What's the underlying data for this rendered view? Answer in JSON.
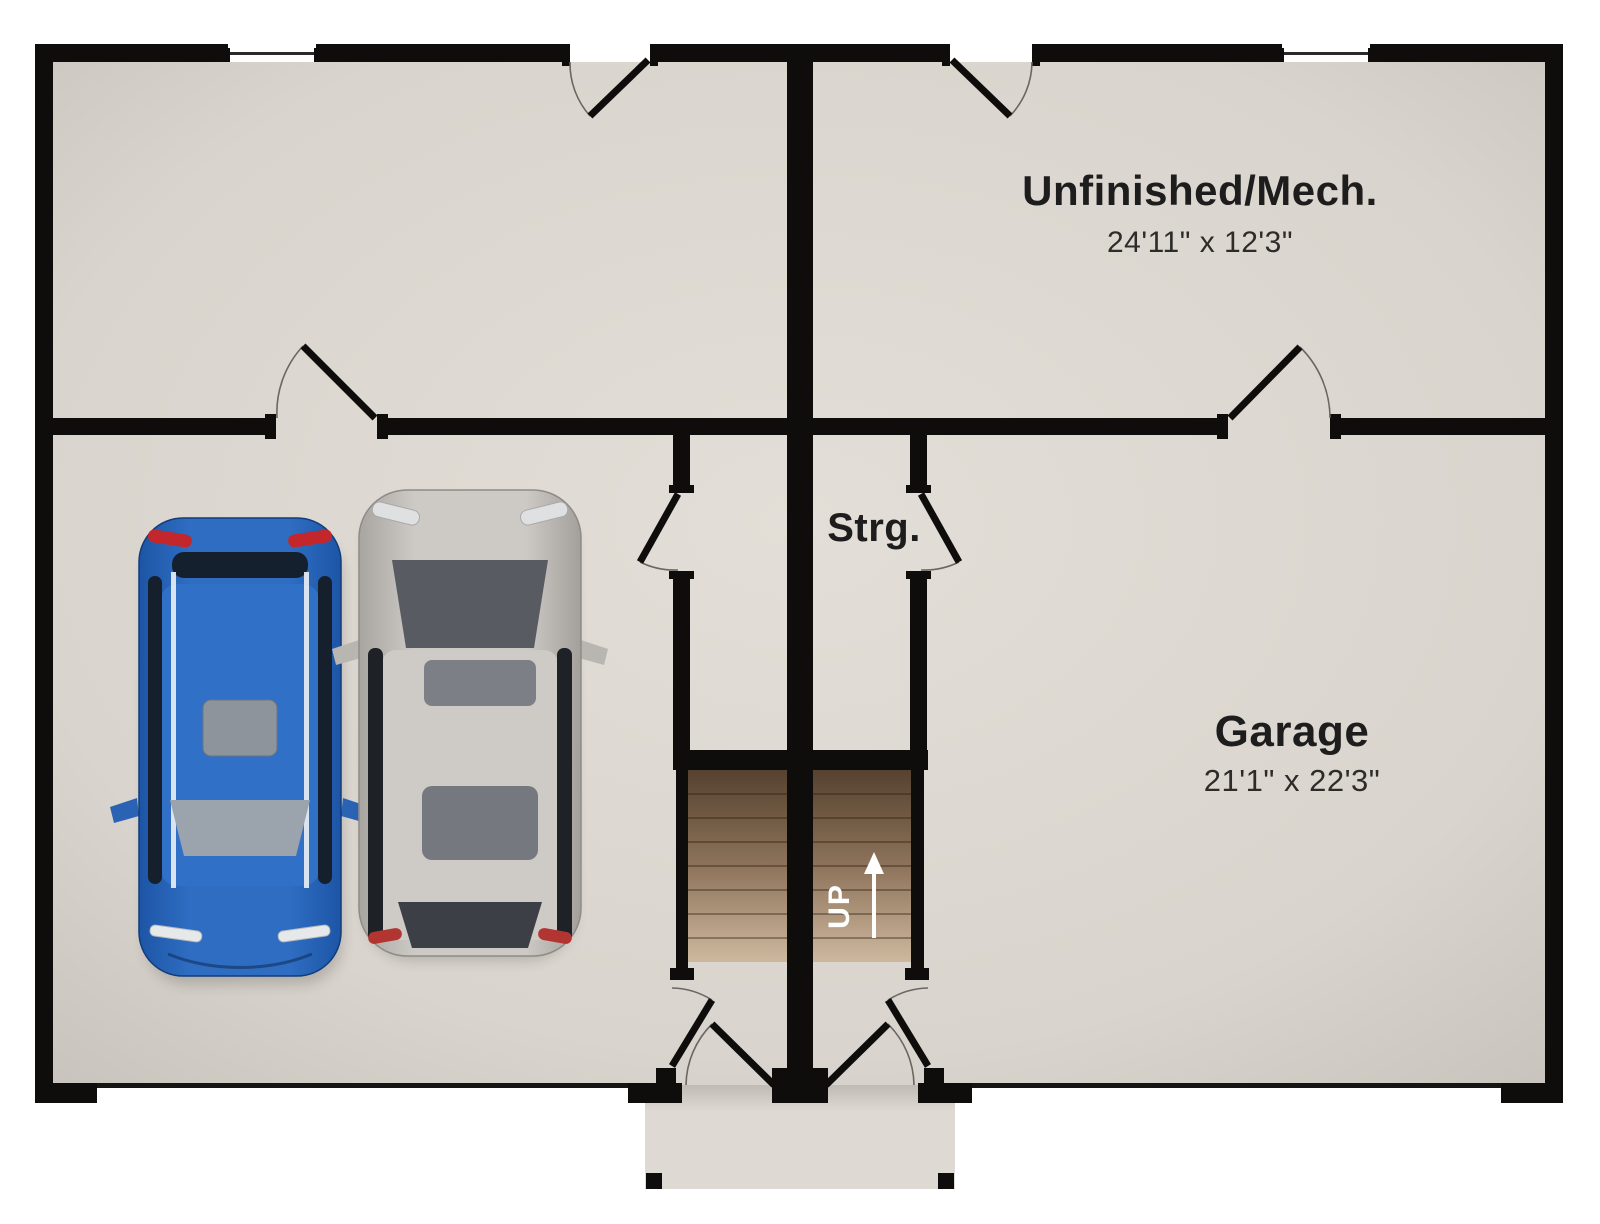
{
  "page": {
    "type": "floor-plan",
    "level": "garage-basement"
  },
  "labels": {
    "unfinished_name": "Unfinished/Mech.",
    "unfinished_dims": "24'11\" x 12'3\"",
    "garage_name": "Garage",
    "garage_dims": "21'1\" x 22'3\"",
    "storage_name": "Strg.",
    "stairs_up": "UP"
  },
  "rooms": [
    {
      "name": "Unfinished/Mech.",
      "dims": "24'11\" x 12'3\""
    },
    {
      "name": "Garage",
      "dims": "21'1\" x 22'3\""
    },
    {
      "name": "Strg.",
      "dims": ""
    }
  ],
  "colors": {
    "wall": "#0e0d0b",
    "floor": "#dcd7d0",
    "floor_edge": "#cbc6bf",
    "porch": "#ded9d2",
    "stair_top": "#5f4b3a",
    "stair_bottom": "#cdb89e",
    "car_blue": "#2e6dc2",
    "car_silver": "#c9c5c1",
    "label_text": "#1d1d1d",
    "up_text": "#ffffff"
  }
}
